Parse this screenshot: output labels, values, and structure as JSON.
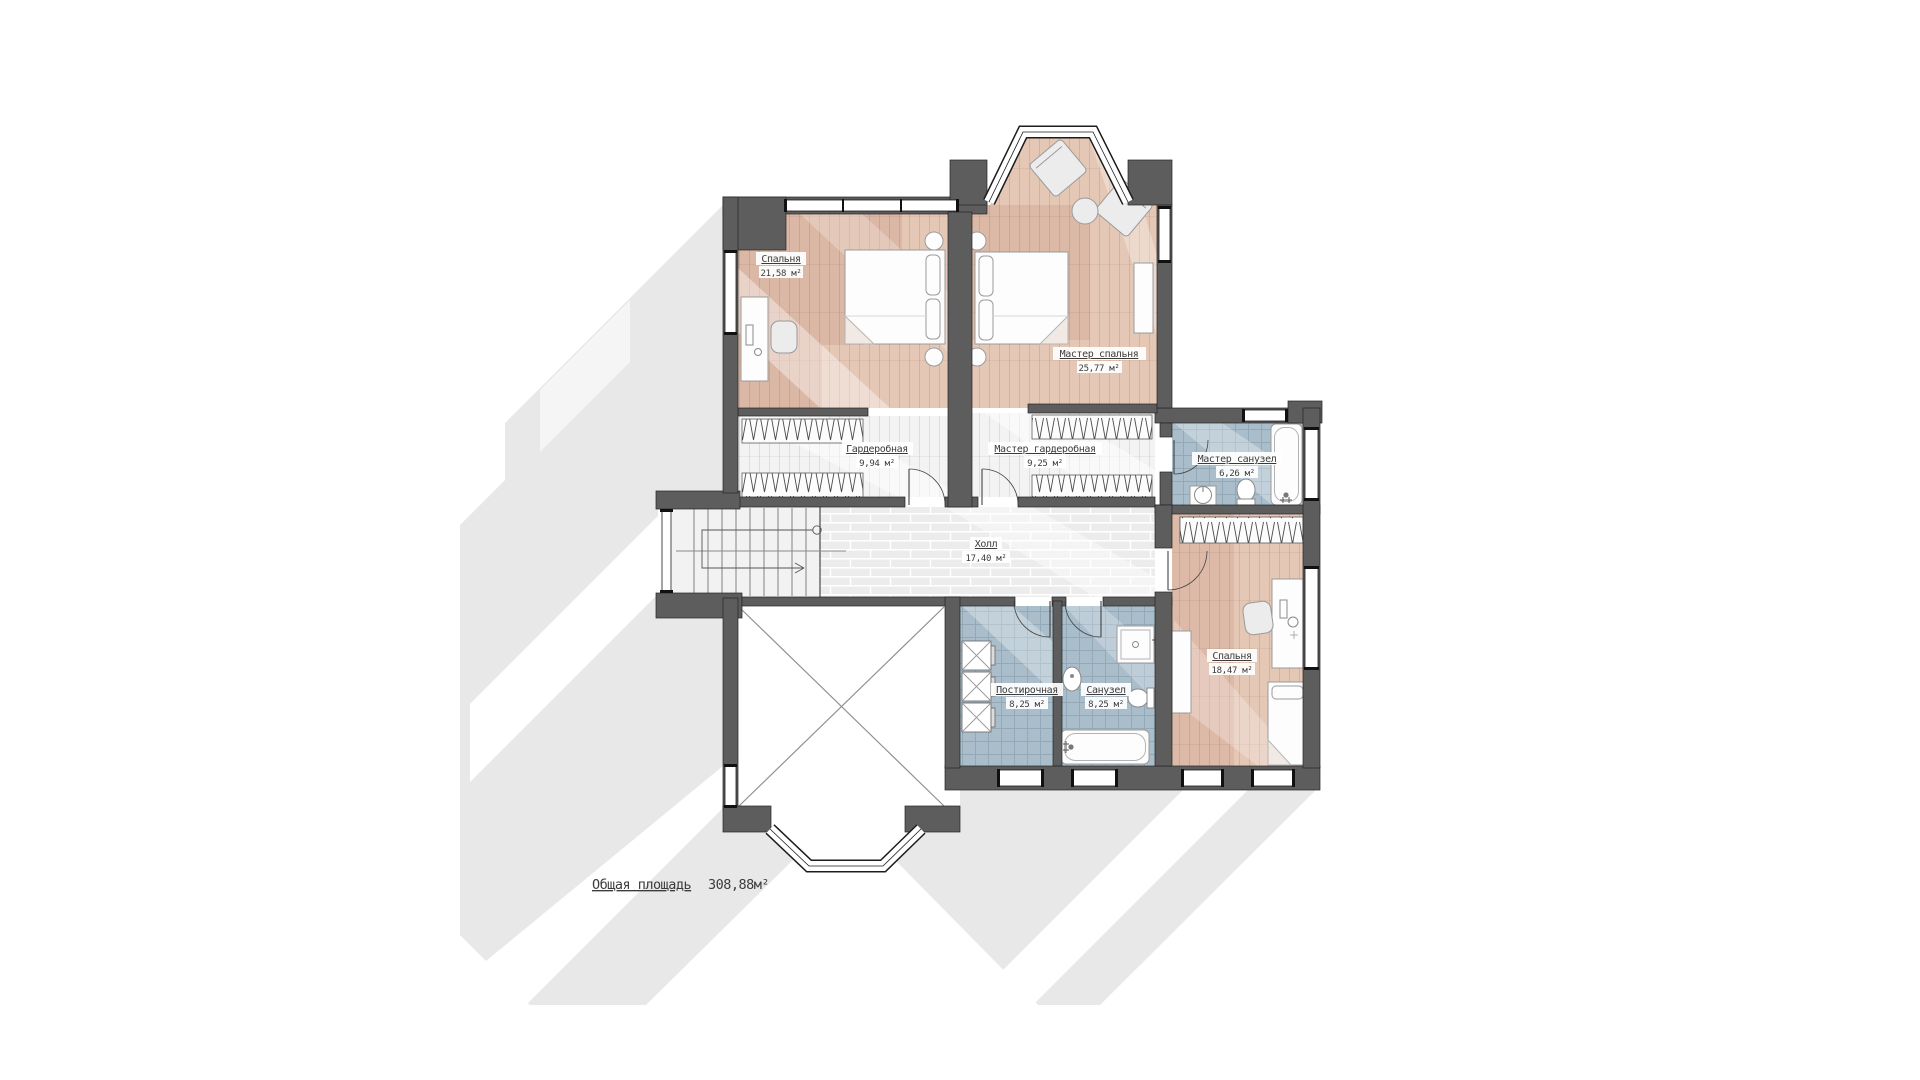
{
  "plan": {
    "type": "architectural floor plan, second storey",
    "rooms": [
      {
        "id": "bedroom-1",
        "name": "Спальня",
        "area": "21,58 м²"
      },
      {
        "id": "master-bedroom",
        "name": "Мастер спальня",
        "area": "25,77 м²"
      },
      {
        "id": "wardrobe",
        "name": "Гардеробная",
        "area": "9,94 м²"
      },
      {
        "id": "master-wardrobe",
        "name": "Мастер гардеробная",
        "area": "9,25 м²"
      },
      {
        "id": "master-bath",
        "name": "Мастер санузел",
        "area": "6,26 м²"
      },
      {
        "id": "hall",
        "name": "Холл",
        "area": "17,40 м²"
      },
      {
        "id": "laundry",
        "name": "Постирочная",
        "area": "8,25 м²"
      },
      {
        "id": "bathroom",
        "name": "Санузел",
        "area": "8,25 м²"
      },
      {
        "id": "bedroom-2",
        "name": "Спальня",
        "area": "18,47 м²"
      }
    ],
    "total": {
      "label": "Общая площадь",
      "value": "308,88м²"
    }
  },
  "colors": {
    "wall": "#5d5d5d",
    "floor_tan": "#e5c7b6",
    "floor_tan_dark": "#d9b4a2",
    "floor_light": "#f3f3f3",
    "tile_blue": "#a9bdca",
    "hall_brick": "#ececec",
    "shadow": "#e8e8e8",
    "text": "#3b3b3b"
  }
}
